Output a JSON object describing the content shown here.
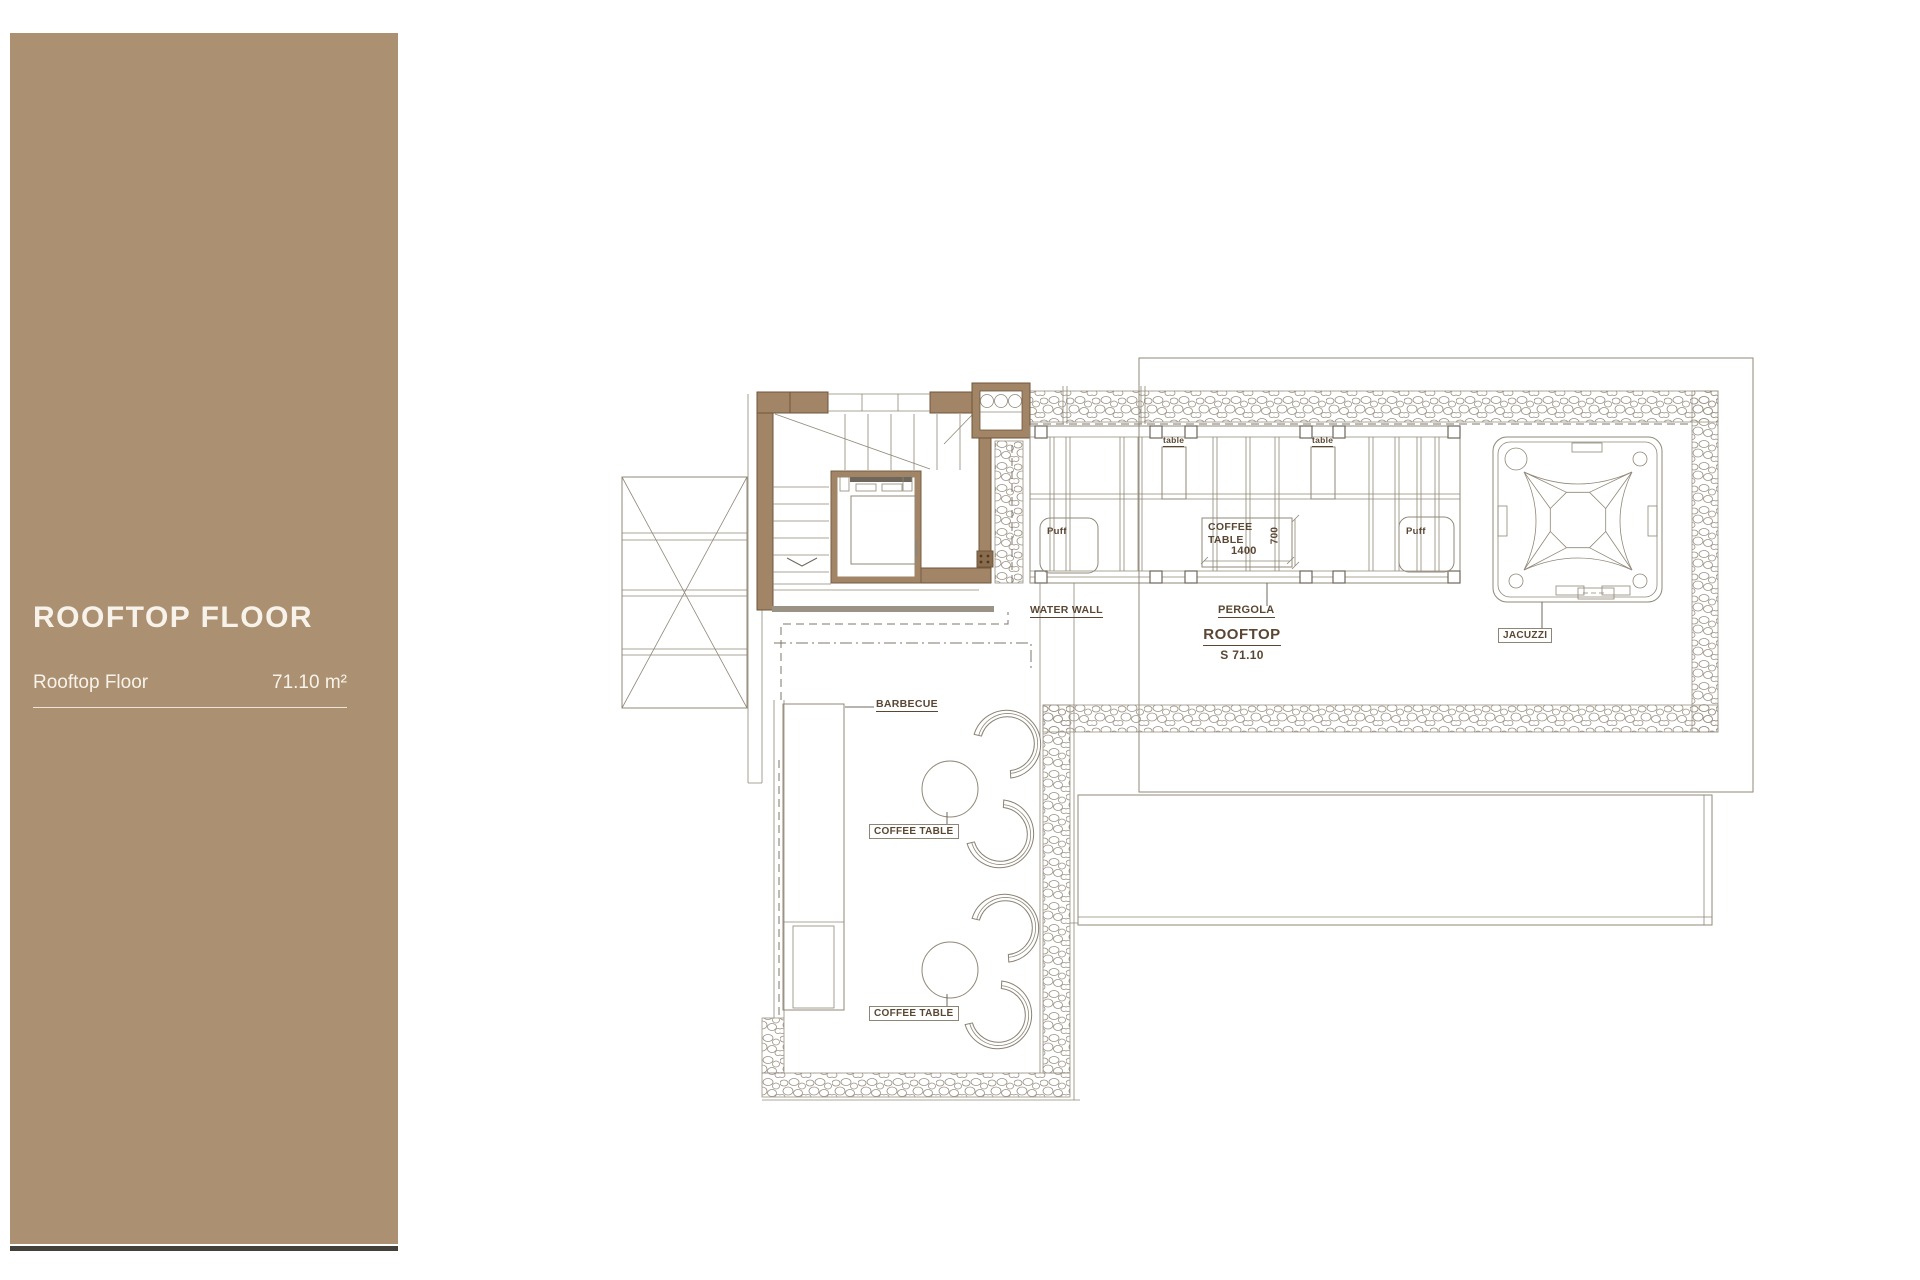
{
  "sidebar": {
    "title": "ROOFTOP FLOOR",
    "floor_name": "Rooftop Floor",
    "floor_area": "71.10 m²"
  },
  "plan": {
    "room_label": "ROOFTOP",
    "room_area": "S 71.10",
    "pergola_label": "PERGOLA",
    "water_wall_label": "WATER WALL",
    "jacuzzi_label": "JACUZZI",
    "barbecue_label": "BARBECUE",
    "coffee_table_label_1": "COFFEE TABLE",
    "coffee_table_label_2": "COFFEE TABLE",
    "coffee_table_pergola": "COFFEE\nTABLE",
    "dim_width": "1400",
    "dim_depth": "700",
    "table_label_1": "table",
    "table_label_2": "table",
    "puff_label_1": "Puff",
    "puff_label_2": "Puff"
  },
  "colors": {
    "sidebar_bg": "#ab9072",
    "sidebar_text": "#f7f3ea",
    "wall_fill": "#a28466",
    "wall_stroke": "#6d563b",
    "line": "#908878",
    "label_text": "#5a4733"
  }
}
